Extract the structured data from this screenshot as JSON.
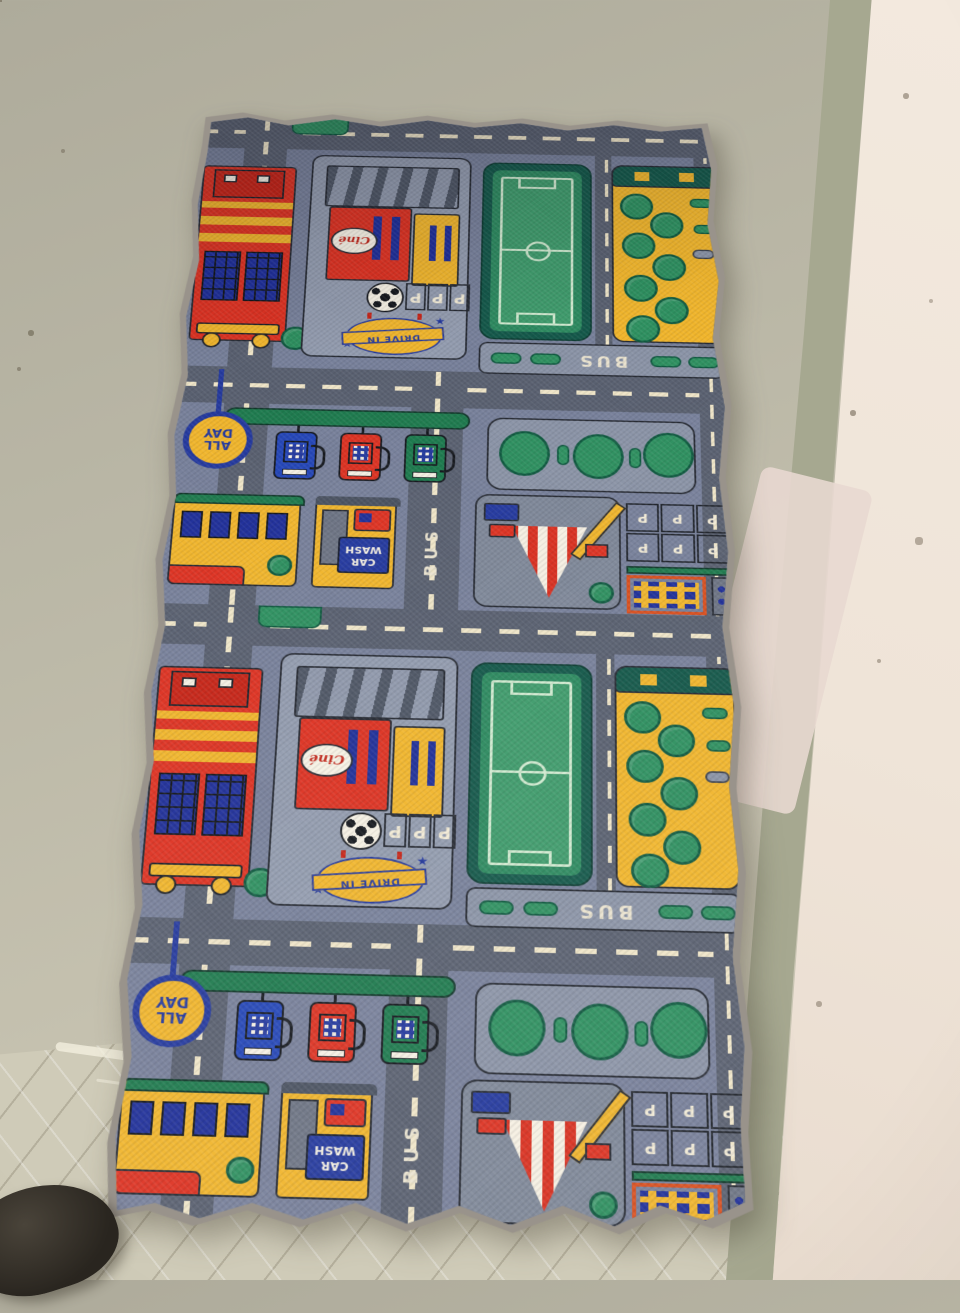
{
  "scene": {
    "description": "Children's city roadway play rug lying on a painted concrete floor beside a whitewashed wall; a dark shoe tip shows at bottom left",
    "floor_color": "#bab7a6",
    "floor_tile_color": "#cfcbb8",
    "wall_color": "#efe4d8",
    "wall_stripe_color": "#a6a890",
    "wall_patch_color": "#e8d8d0",
    "shoe_color": "#29251f"
  },
  "rug": {
    "binding_color": "#99938b",
    "base_color": "#77809a",
    "road_color": "#596070",
    "road_line_color": "#efe5c8",
    "pad_color": "#929bae",
    "green": "#2e9060",
    "dark_green": "#14584a",
    "yellow": "#f0b52c",
    "red": "#dd3222",
    "blue": "#2446b8",
    "labels": {
      "drive_in": "DRIVE IN",
      "car_wash": "CAR WASH",
      "bus": "BUS",
      "all_day": "ALL DAY",
      "cinema": "Ciné",
      "parking": "P",
      "arrow": "↑",
      "star": "★"
    }
  }
}
